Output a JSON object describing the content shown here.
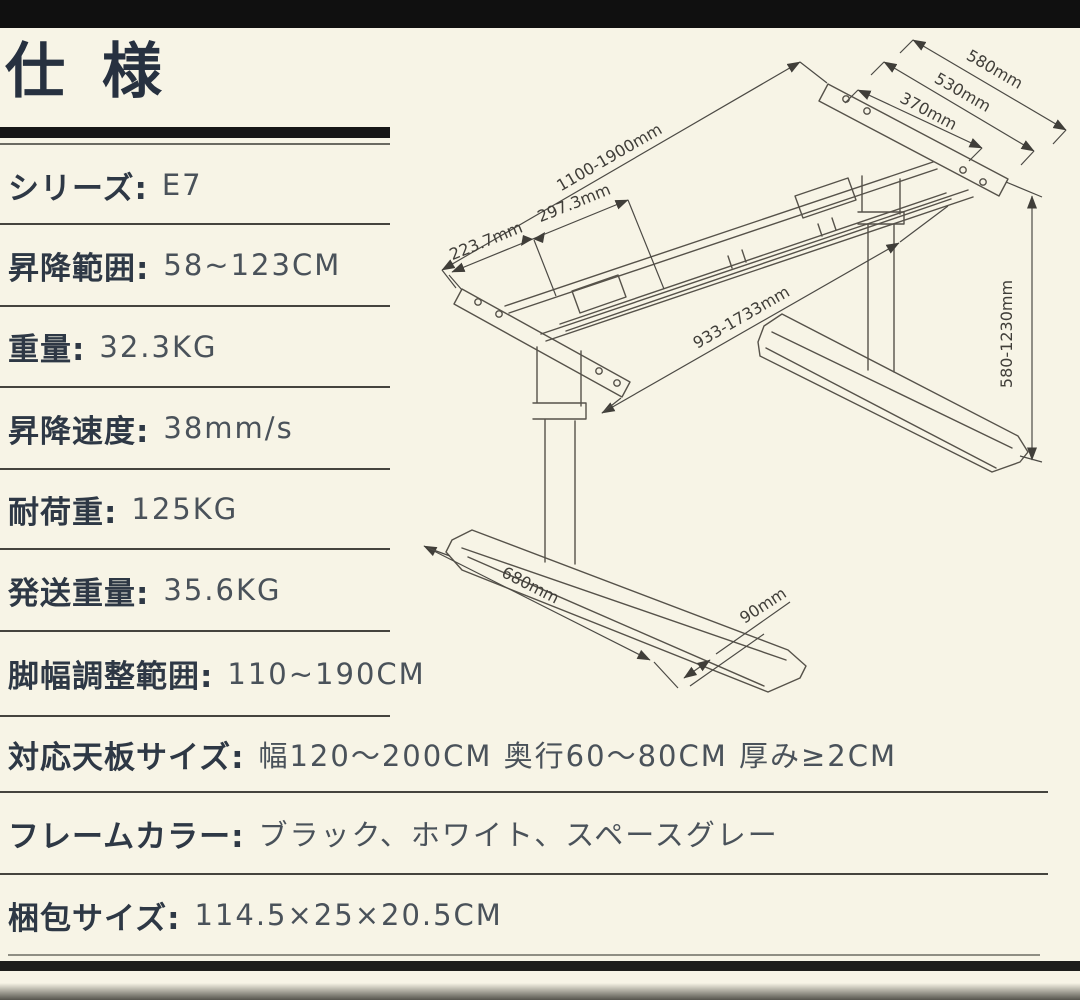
{
  "page": {
    "title": "仕 様"
  },
  "specs": [
    {
      "label": "シリーズ:",
      "value": "E7"
    },
    {
      "label": "昇降範囲:",
      "value": "58~123CM"
    },
    {
      "label": "重量:",
      "value": "32.3KG"
    },
    {
      "label": "昇降速度:",
      "value": "38mm/s"
    },
    {
      "label": "耐荷重:",
      "value": "125KG"
    },
    {
      "label": "発送重量:",
      "value": "35.6KG"
    },
    {
      "label": "脚幅調整範囲:",
      "value": "110~190CM"
    },
    {
      "label": "対応天板サイズ:",
      "value": "幅120～200CM 奥行60～80CM 厚み≥2CM"
    },
    {
      "label": "フレームカラー:",
      "value": "ブラック、ホワイト、スペースグレー"
    },
    {
      "label": "梱包サイズ:",
      "value": "114.5×25×20.5CM"
    }
  ],
  "diagram": {
    "description": "isometric line drawing of height-adjustable desk frame",
    "dims": {
      "top_580": "580mm",
      "mid_530": "530mm",
      "inner_370": "370mm",
      "length_range": "1100-1900mm",
      "seg_223": "223.7mm",
      "seg_297": "297.3mm",
      "beam_range": "933-1733mm",
      "height_range": "580-1230mm",
      "foot_length": "680mm",
      "foot_width": "90mm"
    }
  },
  "colors": {
    "background": "#f7f4e6",
    "top_bar": "#101010",
    "label_text": "#2e3845",
    "value_text": "#4a525a",
    "divider": "#45443e",
    "drawing_stroke": "#56524a"
  }
}
